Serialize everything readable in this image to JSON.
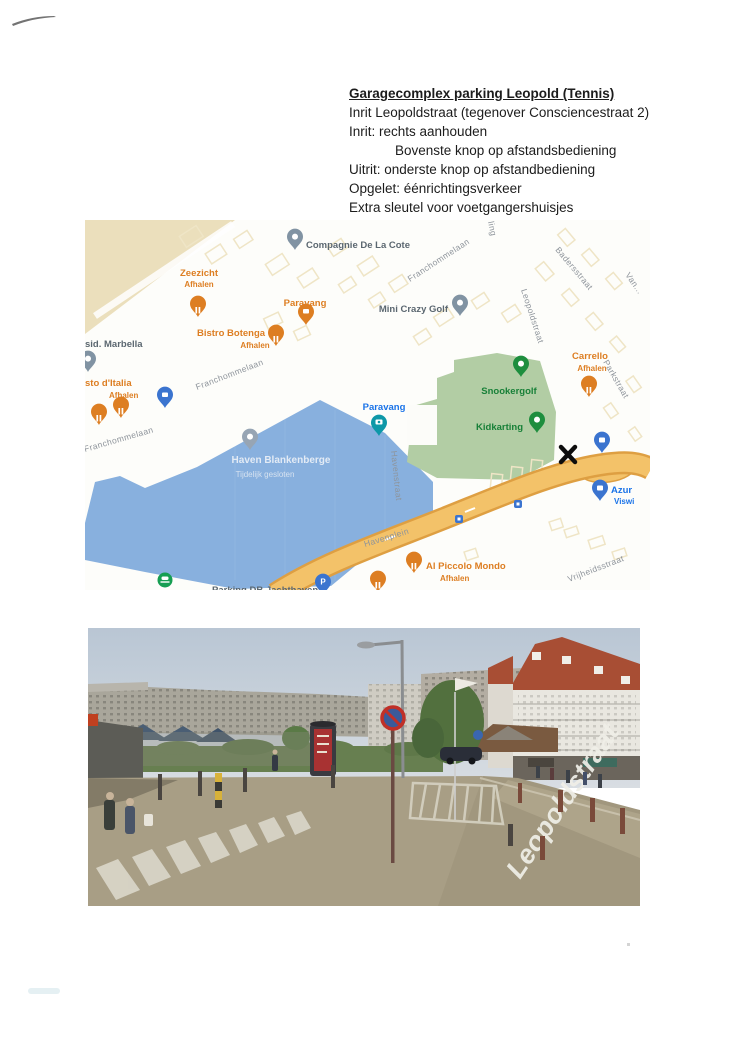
{
  "document": {
    "title": "Garagecomplex parking Leopold (Tennis)",
    "lines": [
      {
        "text": "Inrit Leopoldstraat (tegenover Consciencestraat 2)",
        "indent": false
      },
      {
        "text": "Inrit: rechts aanhouden",
        "indent": false
      },
      {
        "text": "Bovenste knop op afstandsbediening",
        "indent": true
      },
      {
        "text": "Uitrit: onderste knop op afstandbediening",
        "indent": false
      },
      {
        "text": "Opgelet: éénrichtingsverkeer",
        "indent": false
      },
      {
        "text": "Extra sleutel voor voetgangershuisjes",
        "indent": false
      }
    ]
  },
  "map": {
    "pois": [
      {
        "name": "Compagnie De La Cote"
      },
      {
        "name": "Zeezicht",
        "sub": "Afhalen"
      },
      {
        "name": "Paravang"
      },
      {
        "name": "Bistro Botenga",
        "sub": "Afhalen"
      },
      {
        "name": "sid. Marbella"
      },
      {
        "name": "sto d'Italia",
        "sub": "Afhalen"
      },
      {
        "name": "Mini Crazy Golf"
      },
      {
        "name": "Snookergolf"
      },
      {
        "name": "Carrello",
        "sub": "Afhalen"
      },
      {
        "name": "Paravang"
      },
      {
        "name": "Kidkarting"
      },
      {
        "name": "Azur",
        "sub": "Viswi"
      },
      {
        "name": "Al Piccolo Mondo",
        "sub": "Afhalen"
      },
      {
        "name": "Parking DB  Jachthaven"
      },
      {
        "name": "Haven Blankenberge",
        "sub": "Tijdelijk gesloten"
      }
    ],
    "streets": [
      {
        "label": "Franchommelaan"
      },
      {
        "label": "Franchommelaan"
      },
      {
        "label": "Franchommelaan"
      },
      {
        "label": "Badersstraat"
      },
      {
        "label": "Leopoldstraat"
      },
      {
        "label": "Van..."
      },
      {
        "label": "ling"
      },
      {
        "label": "Parkstraat"
      },
      {
        "label": "Havenstraat"
      },
      {
        "label": "Havenplein"
      },
      {
        "label": "Vrijheidsstraat"
      }
    ],
    "icons": {
      "parking_pin": "P",
      "restaurant_pin": "fork-knife",
      "cafe_pin": "cup",
      "camera_pin": "camera",
      "shopping_pin": "bag",
      "lodging_pin": "bed",
      "ferry_icon": "ferry",
      "x_marker": "handwritten-x"
    },
    "colors": {
      "water": "#88b0de",
      "green_area": "#b2cda4",
      "road": "#f3c269",
      "beach": "#ebdfbc",
      "poi_orange": "#dd7e22",
      "poi_green": "#188038",
      "poi_blue": "#1a73e8"
    }
  },
  "streetview": {
    "street_label": "Leopoldstraat"
  }
}
